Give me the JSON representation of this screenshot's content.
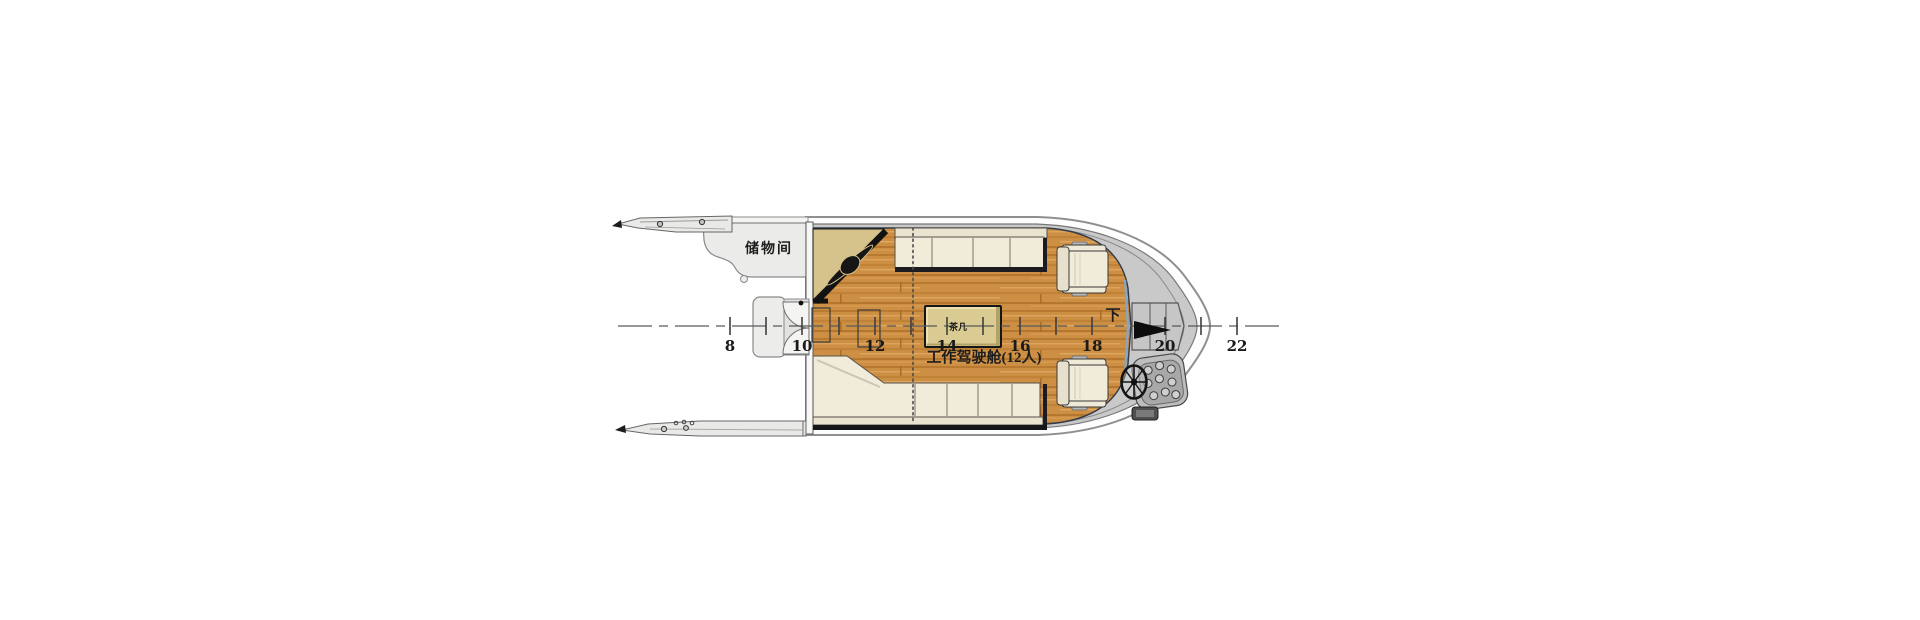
{
  "figure": {
    "type": "boat-deck-plan",
    "background": "#ffffff",
    "labels": {
      "storage_room": "储物间",
      "cabin": "工作驾驶舱(12人)",
      "table": "茶几",
      "down": "下"
    },
    "stations": [
      "8",
      "10",
      "12",
      "14",
      "16",
      "18",
      "20",
      "22"
    ],
    "colors": {
      "wood": "#cd8f43",
      "deck_gray": "#c9c9c9",
      "bench_cream": "#f1ebda",
      "platform_tan": "#d6c28b",
      "trim_blue": "#82a7c9",
      "hull_outline": "#8f8f8f",
      "arrow_black": "#0d0d0d"
    }
  }
}
